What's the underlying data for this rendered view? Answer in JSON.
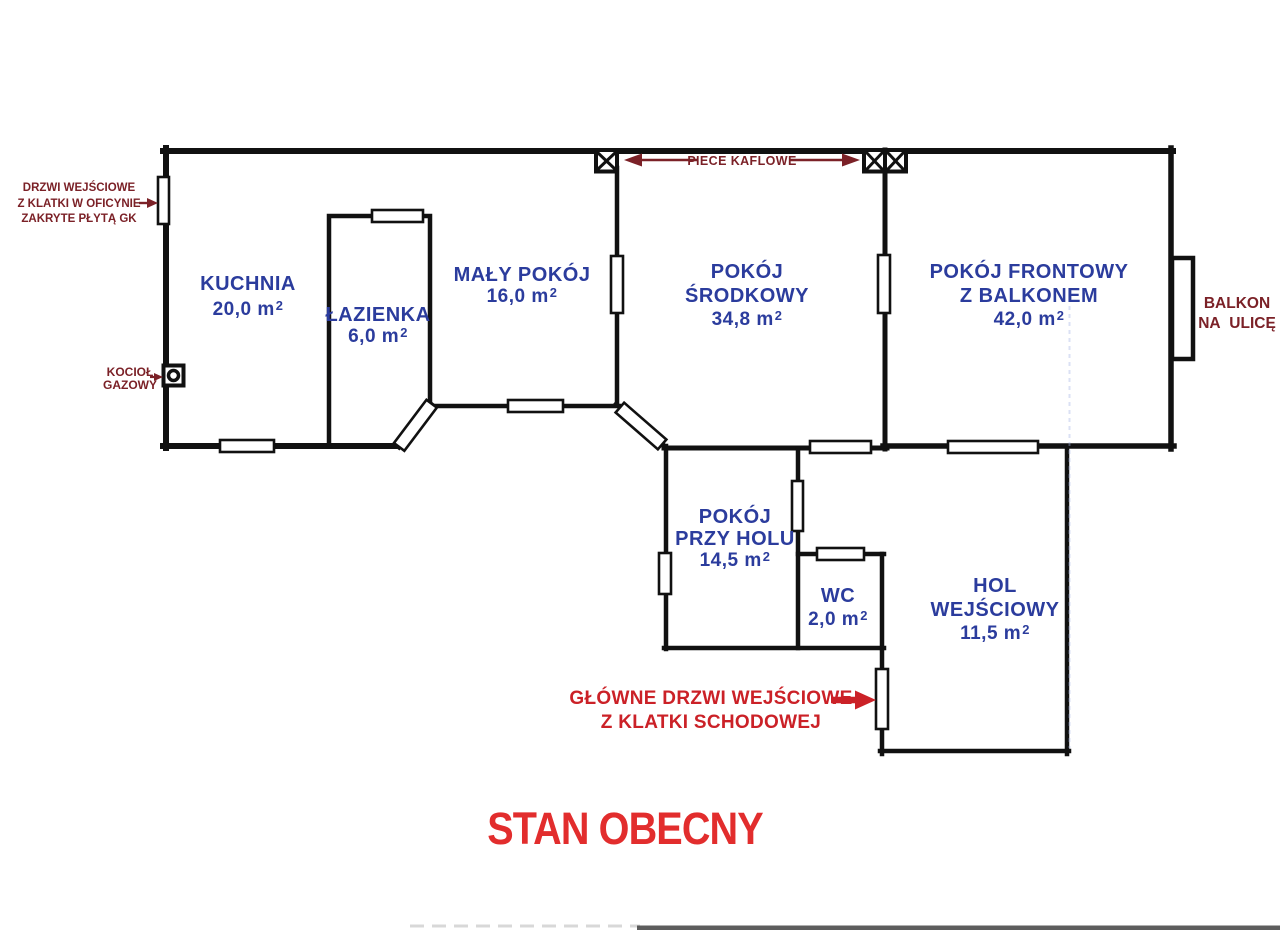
{
  "colors": {
    "wall": "#111111",
    "room-text": "#2b3c9d",
    "note-text": "#7b2127",
    "accent-red": "#cb2127",
    "title-red": "#e22d2d"
  },
  "rooms": [
    {
      "name": "KUCHNIA",
      "area": "20,0 m",
      "sup": "2"
    },
    {
      "name": "ŁAZIENKA",
      "area": "6,0 m",
      "sup": "2"
    },
    {
      "name": "MAŁY POKÓJ",
      "area": "16,0 m",
      "sup": "2"
    },
    {
      "name": "POKÓJ",
      "name2": "ŚRODKOWY",
      "area": "34,8 m",
      "sup": "2"
    },
    {
      "name": "POKÓJ FRONTOWY",
      "name2": "Z BALKONEM",
      "area": "42,0 m",
      "sup": "2"
    },
    {
      "name": "POKÓJ",
      "name2": "PRZY HOLU",
      "area": "14,5 m",
      "sup": "2"
    },
    {
      "name": "WC",
      "area": "2,0 m",
      "sup": "2"
    },
    {
      "name": "HOL",
      "name2": "WEJŚCIOWY",
      "area": "11,5 m",
      "sup": "2"
    }
  ],
  "annotations": {
    "entry_covered": {
      "line1": "DRZWI WEJŚCIOWE",
      "line2": "Z KLATKI W OFICYNIE",
      "line3": "ZAKRYTE PŁYTĄ GK"
    },
    "boiler": {
      "line1": "KOCIOŁ",
      "line2": "GAZOWY"
    },
    "stoves": {
      "label": "PIECE KAFLOWE"
    },
    "balcony": {
      "line1": "BALKON",
      "line2": "NA ULICĘ"
    },
    "main_entrance": {
      "line1": "GŁÓWNE DRZWI WEJŚCIOWE",
      "line2": "Z KLATKI SCHODOWEJ"
    }
  },
  "title": "STAN OBECNY"
}
